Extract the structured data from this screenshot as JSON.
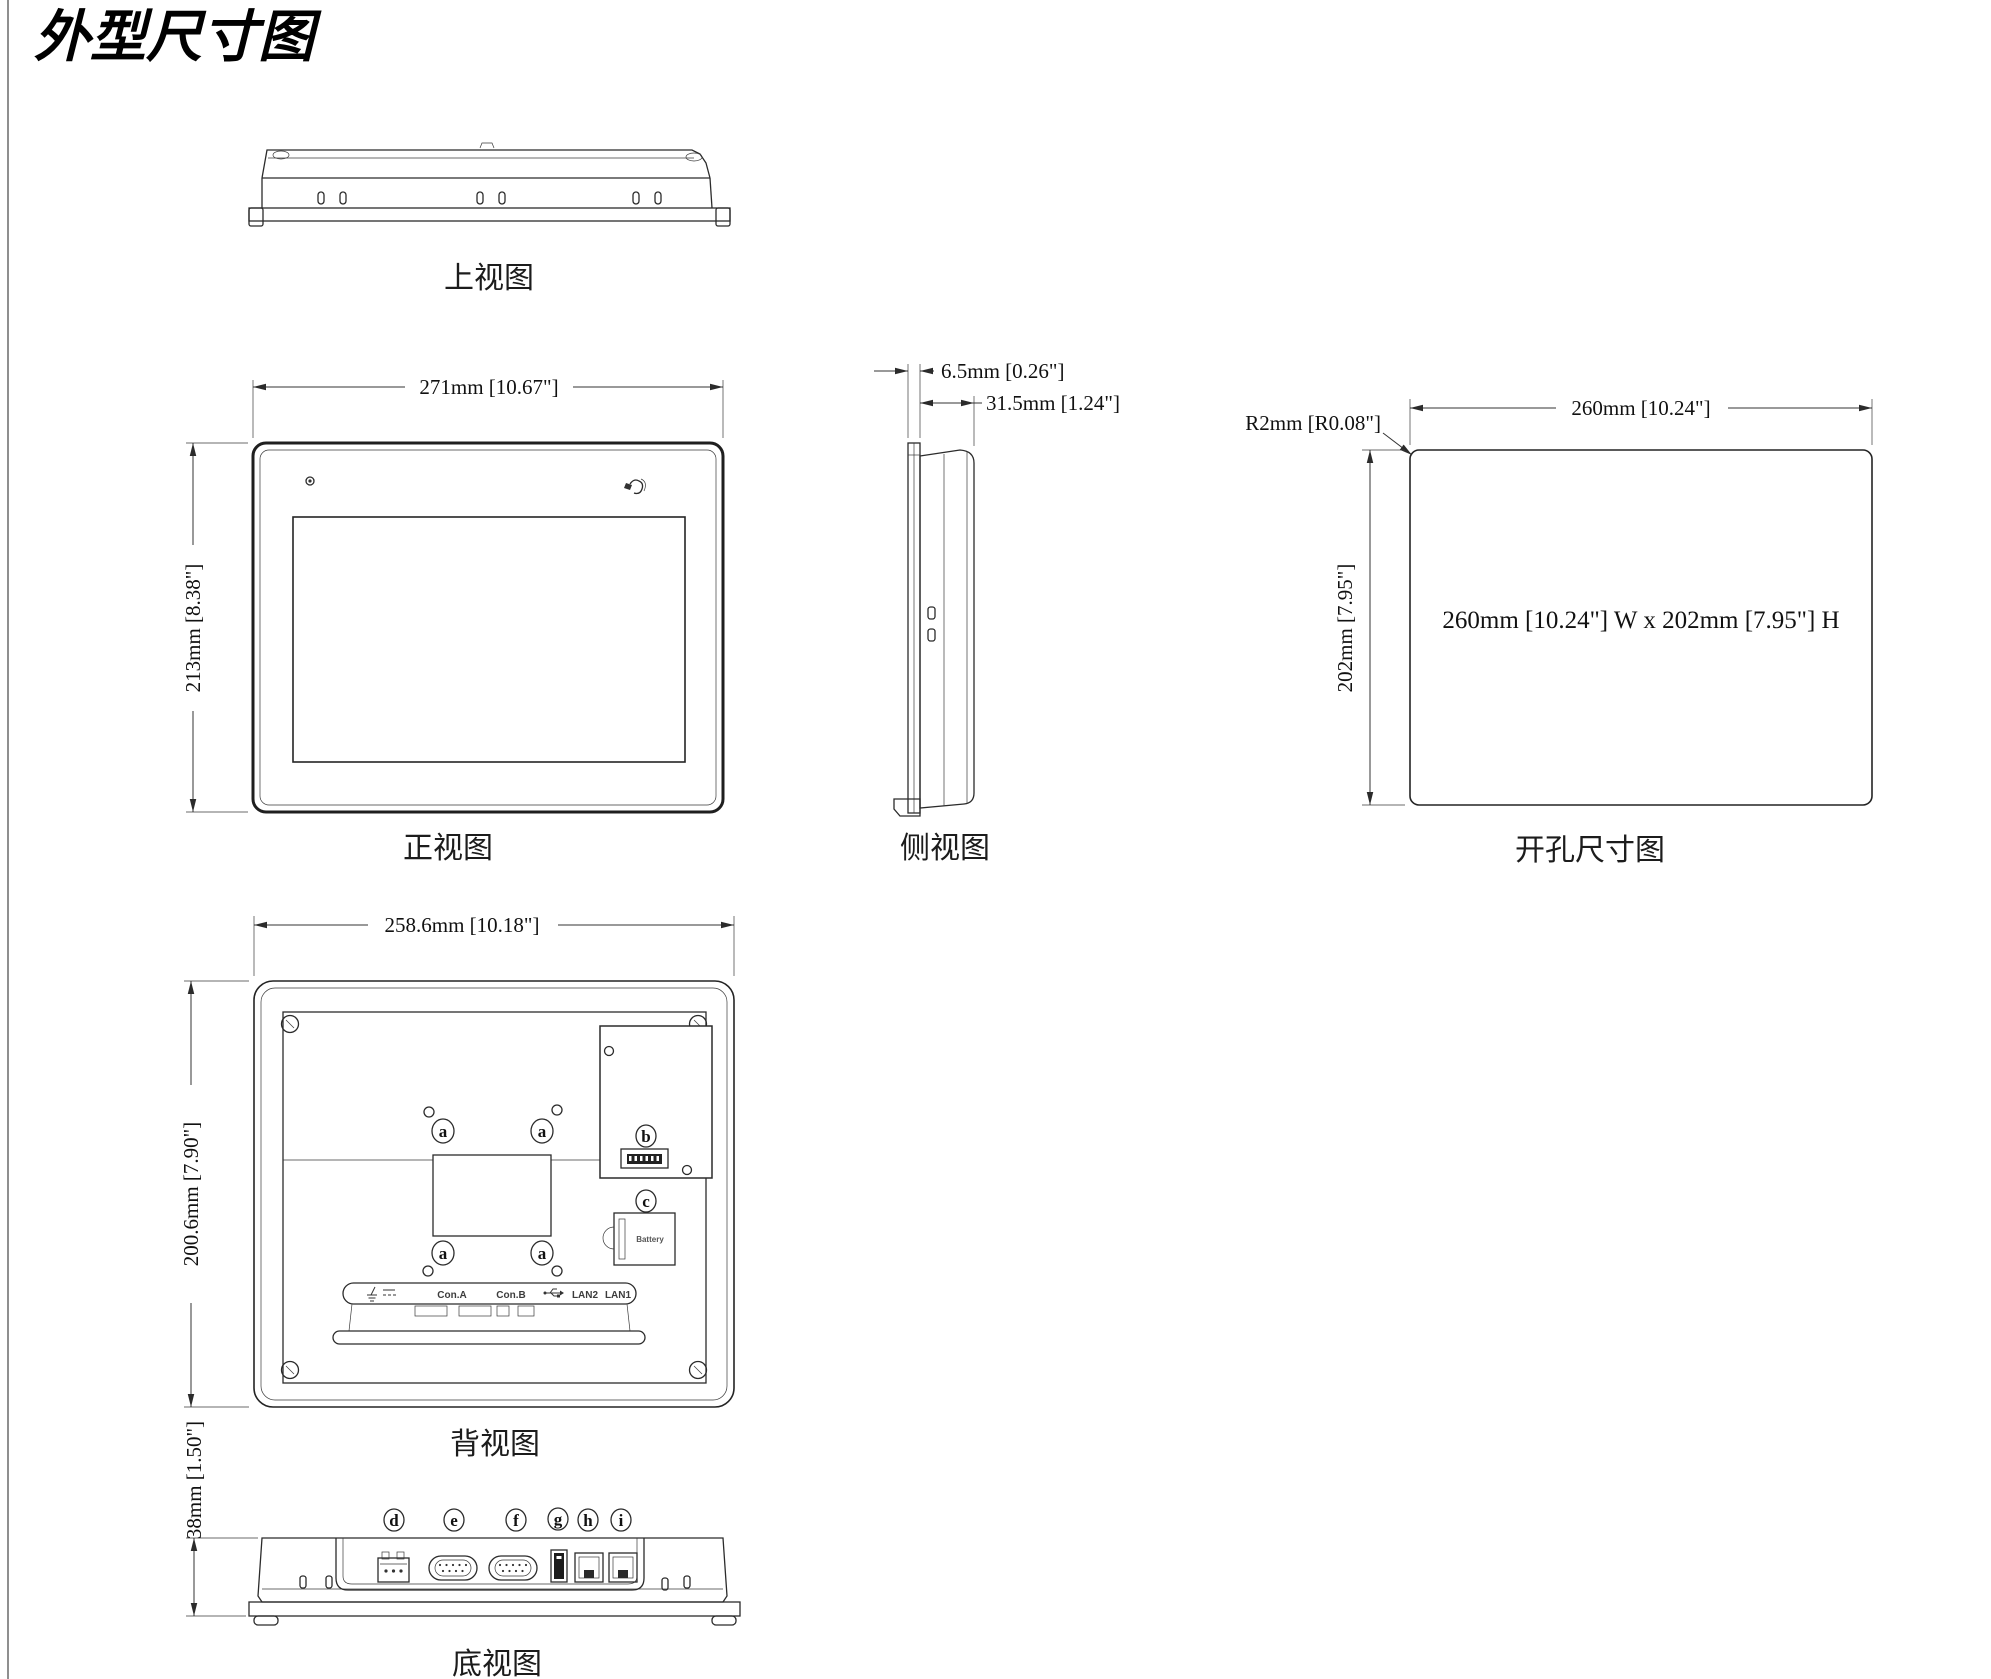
{
  "page": {
    "title": "外型尺寸图"
  },
  "top_view": {
    "label": "上视图"
  },
  "front_view": {
    "label": "正视图",
    "dim_width": "271mm [10.67\"]",
    "dim_height": "213mm [8.38\"]"
  },
  "side_view": {
    "label": "侧视图",
    "dim_bezel": "6.5mm [0.26\"]",
    "dim_depth": "31.5mm [1.24\"]"
  },
  "cutout_view": {
    "label": "开孔尺寸图",
    "dim_width": "260mm [10.24\"]",
    "dim_height": "202mm [7.95\"]",
    "dim_radius": "R2mm [R0.08\"]",
    "note": "260mm [10.24\"] W x 202mm [7.95\"] H"
  },
  "back_view": {
    "label": "背视图",
    "dim_width": "258.6mm [10.18\"]",
    "dim_height": "200.6mm [7.90\"]",
    "callout_a": "a",
    "callout_b": "b",
    "callout_c": "c",
    "battery_label": "Battery",
    "ports": {
      "con_a": "Con.A",
      "con_b": "Con.B",
      "lan2": "LAN2",
      "lan1": "LAN1"
    }
  },
  "bottom_view": {
    "label": "底视图",
    "dim_height": "38mm [1.50\"]",
    "callouts": {
      "d": "d",
      "e": "e",
      "f": "f",
      "g": "g",
      "h": "h",
      "i": "i"
    }
  }
}
